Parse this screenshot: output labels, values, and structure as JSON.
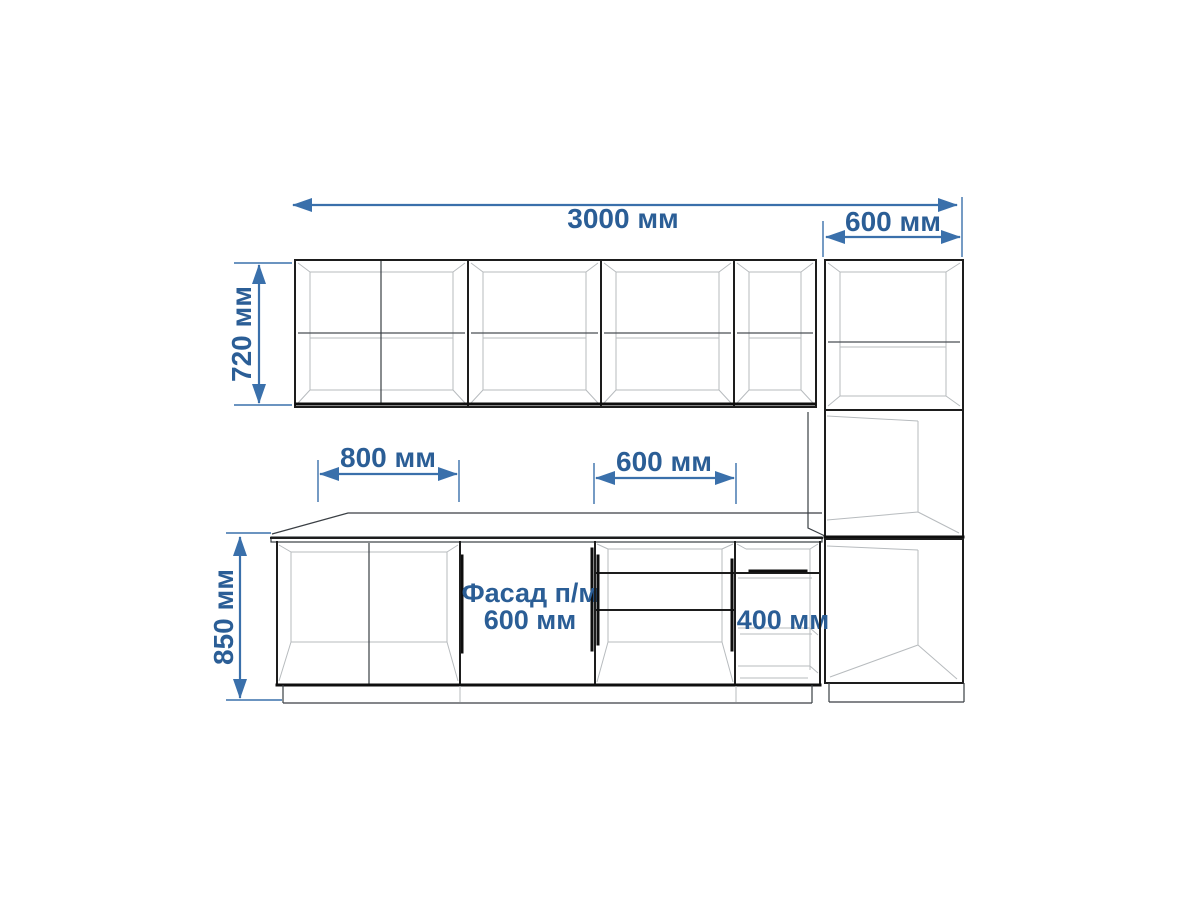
{
  "page": {
    "background": "#ffffff",
    "kind": "kitchen cabinets elevation drawing"
  },
  "drawing": {
    "colors": {
      "dimension_blue_text": "#2b5e96",
      "dimension_blue_line": "#3a70ab",
      "outline_dark": "#1d1d1d",
      "outline_light": "#b7bbbe"
    },
    "dimensions": {
      "total_width_label": "3000 мм",
      "tall_unit_width_label": "600 мм",
      "wall_cabinet_height_label": "720 мм",
      "base_cabinet_height_label": "850 мм",
      "left_base_width_label": "800 мм",
      "mid_base_width_label": "600 мм",
      "drawer_unit_label": "400 мм"
    },
    "annotations": {
      "facade_line1": "Фасад п/м",
      "facade_line2": "600 мм"
    }
  }
}
